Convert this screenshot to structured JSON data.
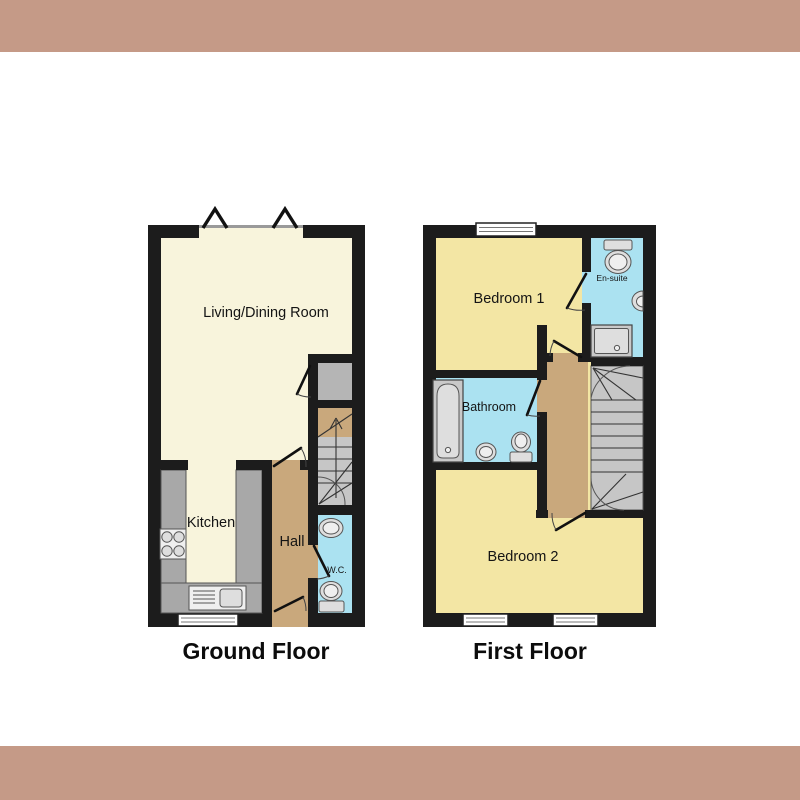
{
  "page": {
    "background": "#ffffff",
    "band_color": "#c59a87"
  },
  "ground_floor": {
    "title": "Ground Floor",
    "rooms": {
      "living_dining": "Living/Dining Room",
      "kitchen": "Kitchen",
      "hall": "Hall",
      "wc": "W.C."
    }
  },
  "first_floor": {
    "title": "First Floor",
    "rooms": {
      "bedroom1": "Bedroom 1",
      "ensuite": "En-suite",
      "bathroom": "Bathroom",
      "bedroom2": "Bedroom 2"
    }
  },
  "colors": {
    "border_band": "#c59a87",
    "wall": "#1c1c1c",
    "living_cream": "#f8f4dc",
    "bedroom_yellow": "#f3e6a4",
    "wet_room_blue": "#abe2f1",
    "hall_tan": "#c9a87c",
    "stairs_gray": "#c6c6c6",
    "counter_gray": "#a8a8a8"
  }
}
